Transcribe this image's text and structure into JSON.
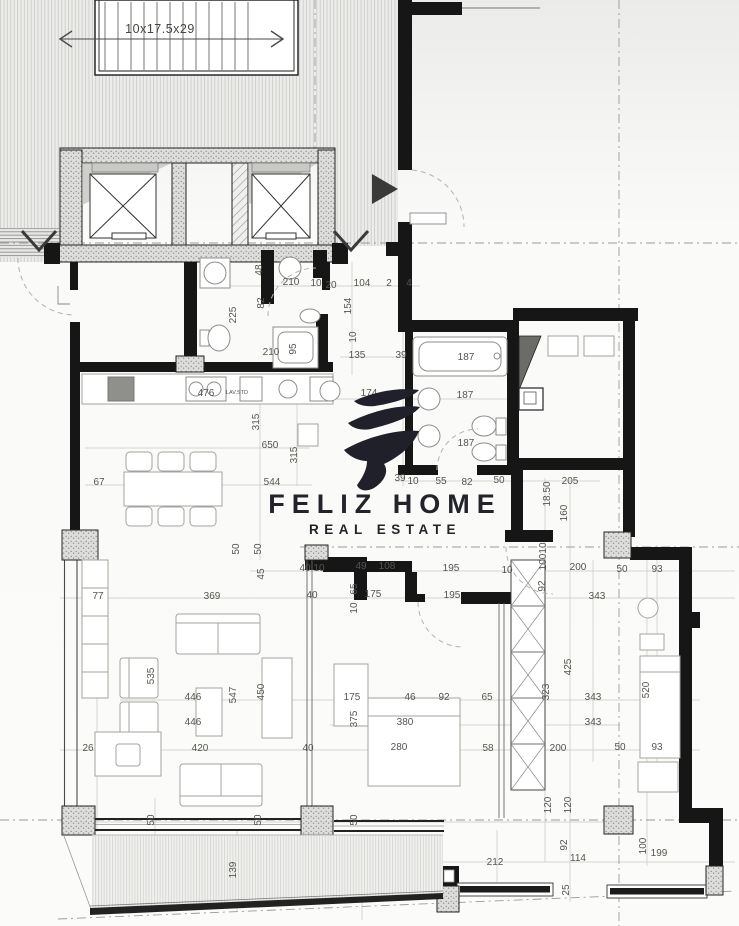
{
  "logo": {
    "brand": "FELIZ HOME",
    "tagline": "REAL ESTATE"
  },
  "plan": {
    "stairs_label": "10x17.5x29",
    "kitchen_note": "LAV.STD"
  },
  "annotations": [
    {
      "t": "10x17.5x29",
      "x": 160,
      "y": 33,
      "v": 0,
      "c": "big"
    },
    {
      "t": "210",
      "x": 291,
      "y": 285,
      "v": 0
    },
    {
      "t": "10",
      "x": 316,
      "y": 286,
      "v": 0
    },
    {
      "t": "20",
      "x": 331,
      "y": 288,
      "v": 0
    },
    {
      "t": "104",
      "x": 362,
      "y": 286,
      "v": 0
    },
    {
      "t": "2",
      "x": 389,
      "y": 286,
      "v": 0
    },
    {
      "t": "4",
      "x": 409,
      "y": 286,
      "v": 0
    },
    {
      "t": "48",
      "x": 262,
      "y": 270,
      "v": 1
    },
    {
      "t": "82",
      "x": 264,
      "y": 303,
      "v": 1
    },
    {
      "t": "225",
      "x": 236,
      "y": 315,
      "v": 1
    },
    {
      "t": "154",
      "x": 351,
      "y": 306,
      "v": 1
    },
    {
      "t": "10",
      "x": 356,
      "y": 337,
      "v": 1
    },
    {
      "t": "135",
      "x": 357,
      "y": 358,
      "v": 0
    },
    {
      "t": "39",
      "x": 401,
      "y": 358,
      "v": 0
    },
    {
      "t": "210",
      "x": 271,
      "y": 355,
      "v": 0
    },
    {
      "t": "95",
      "x": 296,
      "y": 349,
      "v": 1
    },
    {
      "t": "476",
      "x": 206,
      "y": 396,
      "v": 0
    },
    {
      "t": "LAV.STD",
      "x": 237,
      "y": 394,
      "v": 0,
      "c": "sm"
    },
    {
      "t": "315",
      "x": 259,
      "y": 422,
      "v": 1
    },
    {
      "t": "650",
      "x": 270,
      "y": 448,
      "v": 0
    },
    {
      "t": "315",
      "x": 297,
      "y": 455,
      "v": 1
    },
    {
      "t": "544",
      "x": 272,
      "y": 485,
      "v": 0
    },
    {
      "t": "67",
      "x": 99,
      "y": 485,
      "v": 0
    },
    {
      "t": "50",
      "x": 239,
      "y": 549,
      "v": 1
    },
    {
      "t": "50",
      "x": 261,
      "y": 549,
      "v": 1
    },
    {
      "t": "174",
      "x": 369,
      "y": 396,
      "v": 0
    },
    {
      "t": "187",
      "x": 466,
      "y": 360,
      "v": 0
    },
    {
      "t": "187",
      "x": 465,
      "y": 398,
      "v": 0
    },
    {
      "t": "187",
      "x": 466,
      "y": 446,
      "v": 0
    },
    {
      "t": "39",
      "x": 400,
      "y": 481,
      "v": 0
    },
    {
      "t": "10",
      "x": 413,
      "y": 484,
      "v": 0
    },
    {
      "t": "55",
      "x": 441,
      "y": 484,
      "v": 0
    },
    {
      "t": "82",
      "x": 467,
      "y": 485,
      "v": 0
    },
    {
      "t": "50",
      "x": 499,
      "y": 483,
      "v": 0
    },
    {
      "t": "205",
      "x": 570,
      "y": 484,
      "v": 0
    },
    {
      "t": "18.50",
      "x": 550,
      "y": 494,
      "v": 1
    },
    {
      "t": "160",
      "x": 567,
      "y": 513,
      "v": 1
    },
    {
      "t": "10",
      "x": 546,
      "y": 548,
      "v": 1
    },
    {
      "t": "100",
      "x": 546,
      "y": 562,
      "v": 1
    },
    {
      "t": "92",
      "x": 545,
      "y": 586,
      "v": 1
    },
    {
      "t": "40",
      "x": 305,
      "y": 571,
      "v": 0
    },
    {
      "t": "10",
      "x": 319,
      "y": 571,
      "v": 0
    },
    {
      "t": "49",
      "x": 361,
      "y": 569,
      "v": 0
    },
    {
      "t": "108",
      "x": 387,
      "y": 569,
      "v": 0
    },
    {
      "t": "195",
      "x": 451,
      "y": 571,
      "v": 0
    },
    {
      "t": "10",
      "x": 507,
      "y": 573,
      "v": 0
    },
    {
      "t": "200",
      "x": 578,
      "y": 570,
      "v": 0
    },
    {
      "t": "50",
      "x": 622,
      "y": 572,
      "v": 0
    },
    {
      "t": "93",
      "x": 657,
      "y": 572,
      "v": 0
    },
    {
      "t": "45",
      "x": 264,
      "y": 574,
      "v": 1
    },
    {
      "t": "77",
      "x": 98,
      "y": 599,
      "v": 0
    },
    {
      "t": "369",
      "x": 212,
      "y": 599,
      "v": 0
    },
    {
      "t": "40",
      "x": 312,
      "y": 598,
      "v": 0
    },
    {
      "t": "175",
      "x": 373,
      "y": 597,
      "v": 0
    },
    {
      "t": "195",
      "x": 452,
      "y": 598,
      "v": 0
    },
    {
      "t": "343",
      "x": 597,
      "y": 599,
      "v": 0
    },
    {
      "t": "65",
      "x": 357,
      "y": 589,
      "v": 1
    },
    {
      "t": "10",
      "x": 357,
      "y": 608,
      "v": 1
    },
    {
      "t": "535",
      "x": 154,
      "y": 676,
      "v": 1
    },
    {
      "t": "425",
      "x": 571,
      "y": 667,
      "v": 1
    },
    {
      "t": "323",
      "x": 549,
      "y": 692,
      "v": 1
    },
    {
      "t": "520",
      "x": 649,
      "y": 690,
      "v": 1
    },
    {
      "t": "446",
      "x": 193,
      "y": 700,
      "v": 0
    },
    {
      "t": "547",
      "x": 236,
      "y": 695,
      "v": 1
    },
    {
      "t": "450",
      "x": 264,
      "y": 692,
      "v": 1
    },
    {
      "t": "343",
      "x": 593,
      "y": 700,
      "v": 0
    },
    {
      "t": "175",
      "x": 352,
      "y": 700,
      "v": 0
    },
    {
      "t": "46",
      "x": 410,
      "y": 700,
      "v": 0
    },
    {
      "t": "92",
      "x": 444,
      "y": 700,
      "v": 0
    },
    {
      "t": "65",
      "x": 487,
      "y": 700,
      "v": 0
    },
    {
      "t": "446",
      "x": 193,
      "y": 725,
      "v": 0
    },
    {
      "t": "343",
      "x": 593,
      "y": 725,
      "v": 0
    },
    {
      "t": "375",
      "x": 357,
      "y": 719,
      "v": 1
    },
    {
      "t": "380",
      "x": 405,
      "y": 725,
      "v": 0
    },
    {
      "t": "26",
      "x": 88,
      "y": 751,
      "v": 0
    },
    {
      "t": "420",
      "x": 200,
      "y": 751,
      "v": 0
    },
    {
      "t": "40",
      "x": 308,
      "y": 751,
      "v": 0
    },
    {
      "t": "280",
      "x": 399,
      "y": 750,
      "v": 0
    },
    {
      "t": "58",
      "x": 488,
      "y": 751,
      "v": 0
    },
    {
      "t": "200",
      "x": 558,
      "y": 751,
      "v": 0
    },
    {
      "t": "50",
      "x": 620,
      "y": 750,
      "v": 0
    },
    {
      "t": "93",
      "x": 657,
      "y": 750,
      "v": 0
    },
    {
      "t": "50",
      "x": 154,
      "y": 820,
      "v": 1
    },
    {
      "t": "50",
      "x": 261,
      "y": 820,
      "v": 1
    },
    {
      "t": "50",
      "x": 357,
      "y": 820,
      "v": 1
    },
    {
      "t": "120",
      "x": 551,
      "y": 805,
      "v": 1
    },
    {
      "t": "120",
      "x": 571,
      "y": 805,
      "v": 1
    },
    {
      "t": "139",
      "x": 236,
      "y": 870,
      "v": 1
    },
    {
      "t": "212",
      "x": 495,
      "y": 865,
      "v": 0
    },
    {
      "t": "114",
      "x": 578,
      "y": 861,
      "v": 0
    },
    {
      "t": "199",
      "x": 659,
      "y": 856,
      "v": 0
    },
    {
      "t": "100",
      "x": 646,
      "y": 846,
      "v": 1
    },
    {
      "t": "92",
      "x": 567,
      "y": 845,
      "v": 1
    },
    {
      "t": "25",
      "x": 569,
      "y": 890,
      "v": 1
    }
  ]
}
